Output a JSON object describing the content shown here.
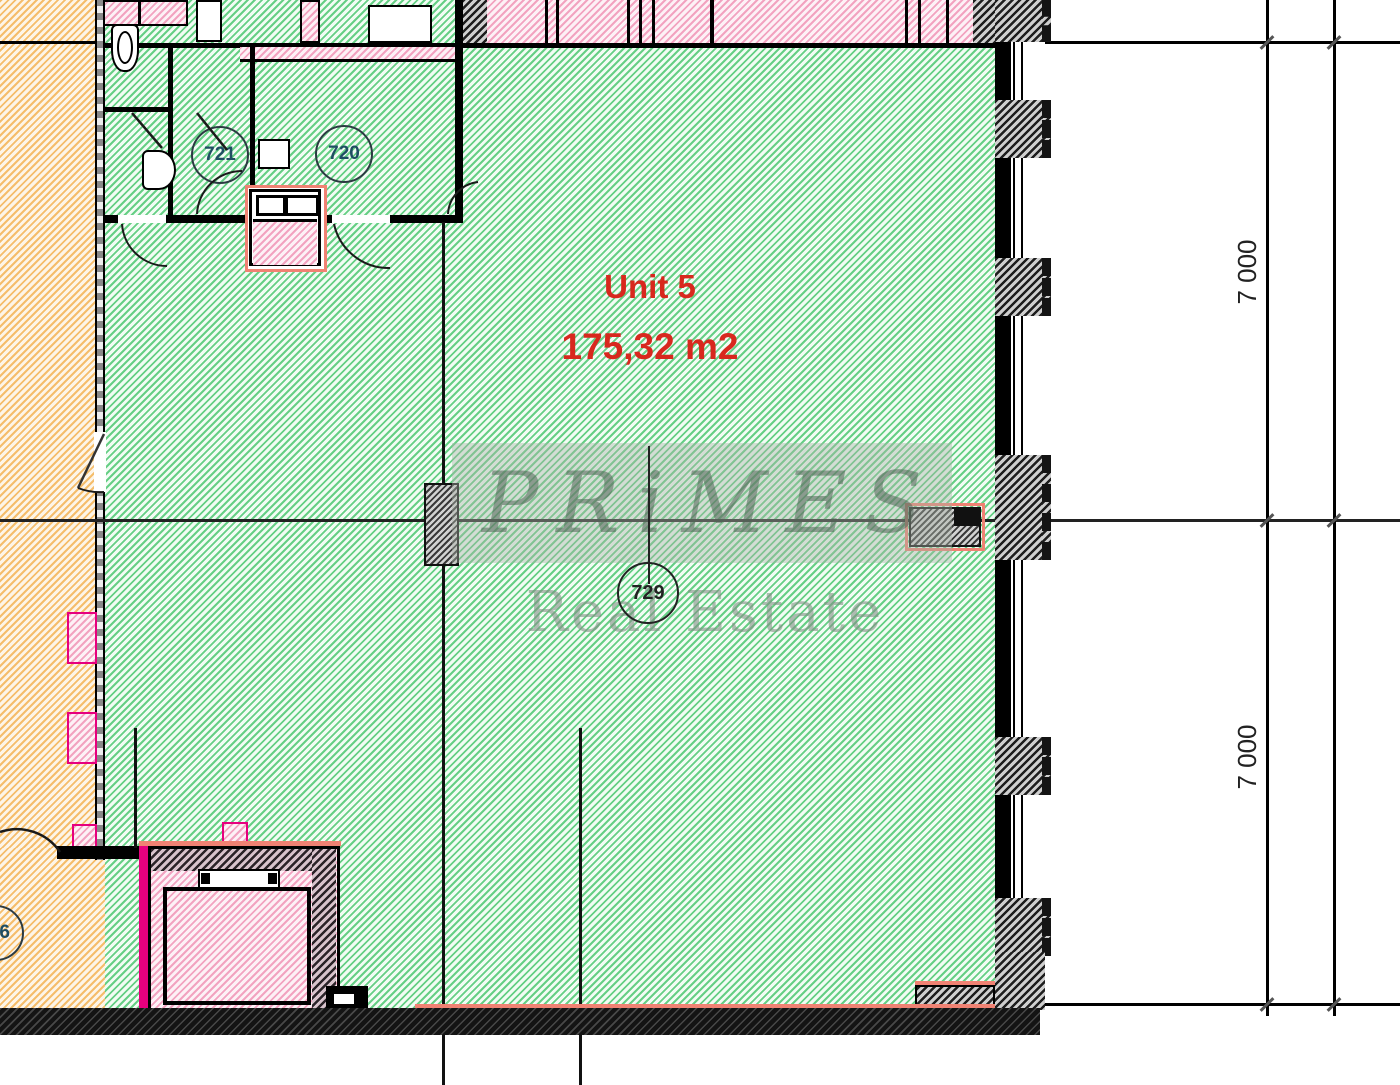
{
  "unit": {
    "title": "Unit 5",
    "area": "175,32 m2"
  },
  "rooms": {
    "r721": "721",
    "r720": "720",
    "r729": "729",
    "r6_partial": "6"
  },
  "dims": {
    "upper": "7 000",
    "lower": "7 000"
  },
  "watermark": {
    "brand_letters": [
      "P",
      "R",
      "i",
      "M",
      "E",
      "S"
    ],
    "subtitle": "Real Estate"
  },
  "colors": {
    "zone_unit_green": "#66cf85",
    "zone_corridor_orange": "#f5bd6b",
    "zone_service_pink": "#f2a3c0",
    "unit_label_red": "#d8281e",
    "accent_salmon": "#f08273",
    "accent_magenta": "#e6007e",
    "wall_black": "#141414",
    "dimension_ink": "#222222",
    "room_tag_ink": "#1f4e63"
  }
}
